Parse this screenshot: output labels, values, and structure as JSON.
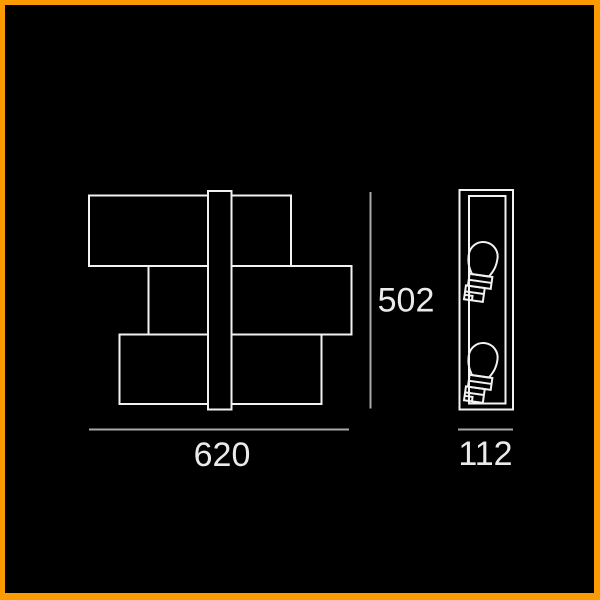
{
  "window": {
    "background_color": "#000000",
    "frame_color": "#fc9a02"
  },
  "drawing": {
    "type": "technical-dimension-drawing",
    "subject": "two-bulb wall lamp with staggered rectangular shades",
    "line_color": "#f2f2f2",
    "dimension_line_color": "#a8a8a8",
    "text_color": "#ebebeb",
    "front_view": {
      "label": "front view",
      "box_count": 3
    },
    "side_view": {
      "label": "side view",
      "bulb_count": 2
    },
    "dimensions": {
      "width_label": "620",
      "height_label": "502",
      "depth_label": "112"
    }
  }
}
